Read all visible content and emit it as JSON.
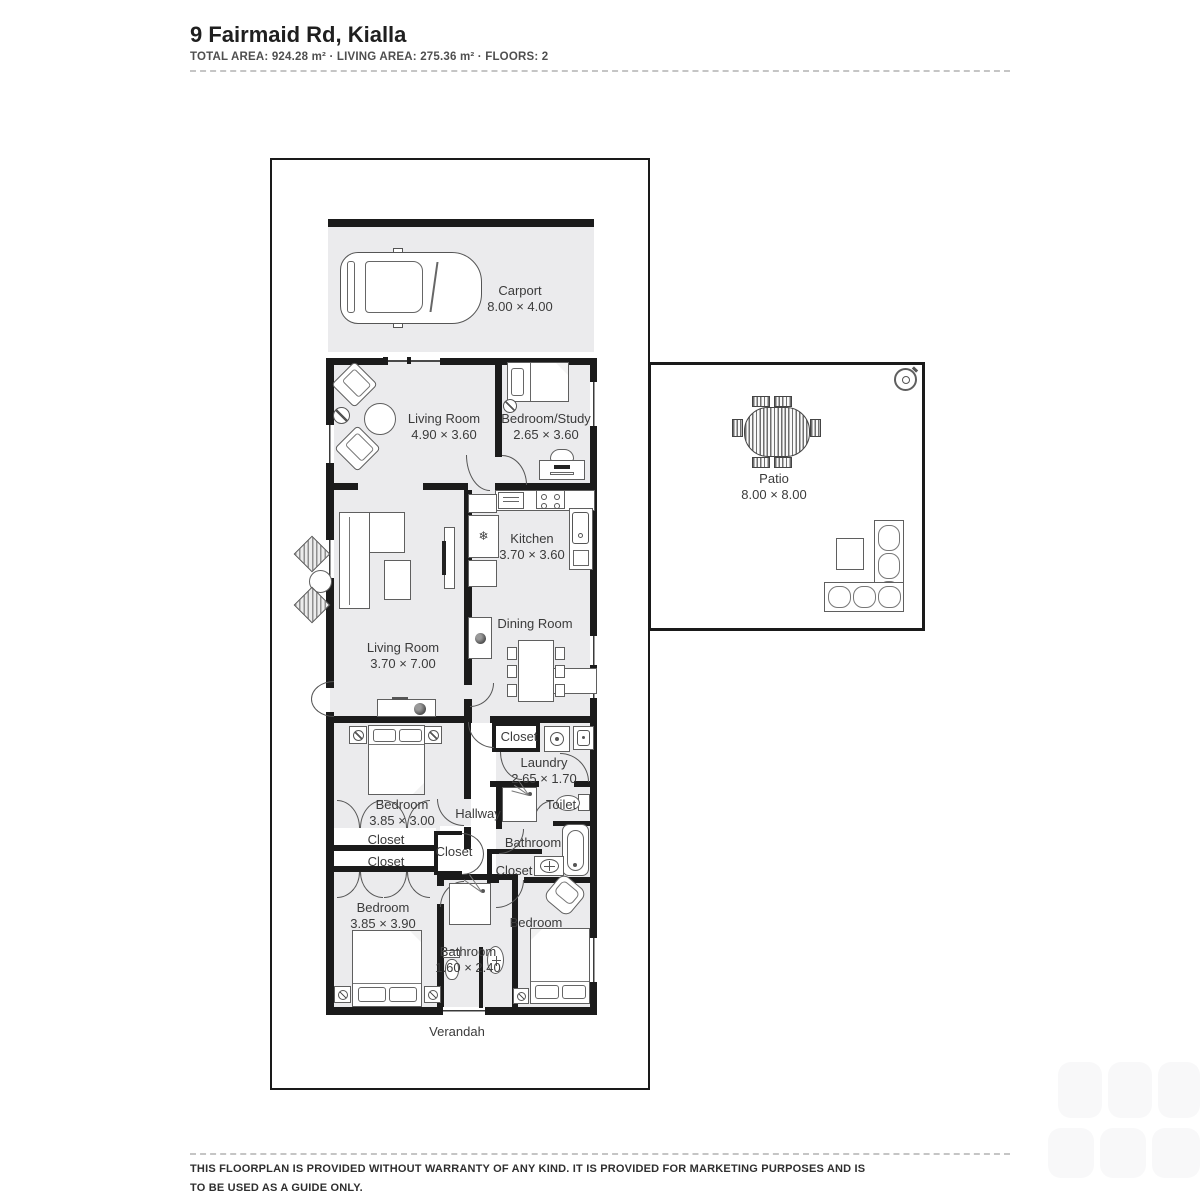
{
  "header": {
    "title": "9 Fairmaid Rd, Kialla",
    "meta": "TOTAL AREA: 924.28 m² · LIVING AREA: 275.36 m² · FLOORS: 2"
  },
  "floorplan": {
    "rooms": [
      {
        "name": "Carport",
        "dims": "8.00 × 4.00",
        "cx": 520,
        "cy": 283
      },
      {
        "name": "Living Room",
        "dims": "4.90 × 3.60",
        "cx": 444,
        "cy": 411
      },
      {
        "name": "Bedroom/Study",
        "dims": "2.65 × 3.60",
        "cx": 546,
        "cy": 411
      },
      {
        "name": "Kitchen",
        "dims": "3.70 × 3.60",
        "cx": 532,
        "cy": 531
      },
      {
        "name": "Dining Room",
        "dims": "",
        "cx": 535,
        "cy": 616
      },
      {
        "name": "Living Room",
        "dims": "3.70 × 7.00",
        "cx": 403,
        "cy": 640
      },
      {
        "name": "Patio",
        "dims": "8.00 × 8.00",
        "cx": 774,
        "cy": 471
      },
      {
        "name": "Closet",
        "dims": "",
        "cx": 519,
        "cy": 729
      },
      {
        "name": "Laundry",
        "dims": "2.65 × 1.70",
        "cx": 544,
        "cy": 755
      },
      {
        "name": "Bedroom",
        "dims": "3.85 × 3.00",
        "cx": 402,
        "cy": 797
      },
      {
        "name": "Hallway",
        "dims": "",
        "cx": 478,
        "cy": 806
      },
      {
        "name": "Toilet",
        "dims": "",
        "cx": 561,
        "cy": 797
      },
      {
        "name": "Bathroom",
        "dims": "",
        "cx": 533,
        "cy": 835
      },
      {
        "name": "Closet",
        "dims": "",
        "cx": 386,
        "cy": 832
      },
      {
        "name": "Closet",
        "dims": "",
        "cx": 386,
        "cy": 854
      },
      {
        "name": "Closet",
        "dims": "",
        "cx": 454,
        "cy": 844
      },
      {
        "name": "Closet",
        "dims": "",
        "cx": 514,
        "cy": 863
      },
      {
        "name": "Bedroom",
        "dims": "3.85 × 3.90",
        "cx": 383,
        "cy": 900
      },
      {
        "name": "Bathroom",
        "dims": "1.60 × 2.40",
        "cx": 468,
        "cy": 944
      },
      {
        "name": "Bedroom",
        "dims": "",
        "cx": 536,
        "cy": 915
      },
      {
        "name": "Verandah",
        "dims": "",
        "cx": 457,
        "cy": 1024
      }
    ],
    "icons": {
      "fridge": "❄"
    }
  },
  "footer": {
    "line1": "THIS FLOORPLAN IS PROVIDED WITHOUT WARRANTY OF ANY KIND. IT IS PROVIDED FOR MARKETING PURPOSES AND IS",
    "line2": "TO BE USED AS A GUIDE ONLY."
  }
}
